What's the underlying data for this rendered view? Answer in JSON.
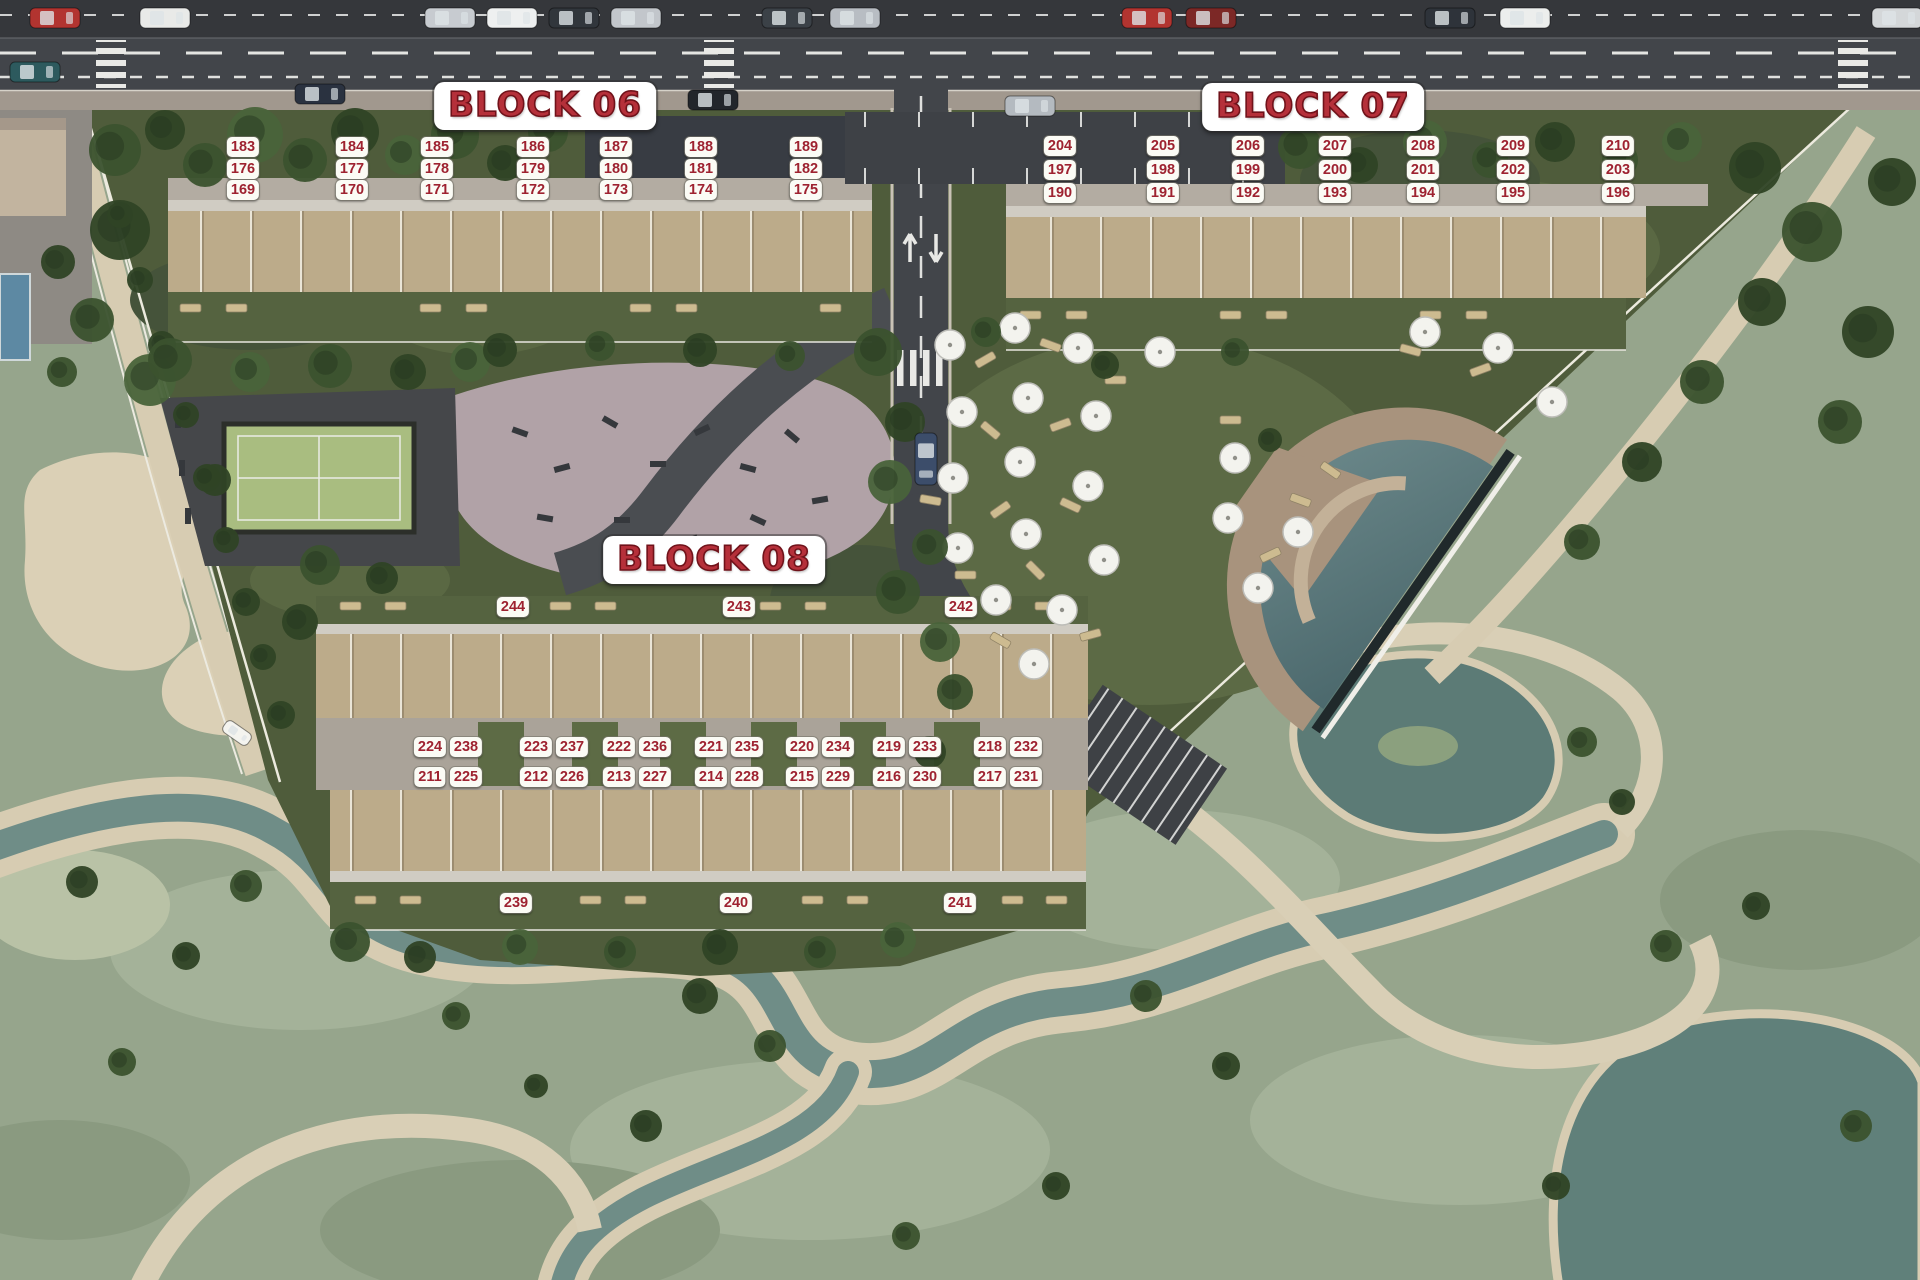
{
  "site": {
    "blocks": [
      {
        "id": "block-06",
        "title": "BLOCK 06",
        "title_x": 545,
        "title_y": 106,
        "units": [
          [
            "183",
            243,
            147
          ],
          [
            "184",
            352,
            147
          ],
          [
            "185",
            437,
            147
          ],
          [
            "186",
            533,
            147
          ],
          [
            "187",
            616,
            147
          ],
          [
            "188",
            701,
            147
          ],
          [
            "189",
            806,
            147
          ],
          [
            "176",
            243,
            169
          ],
          [
            "177",
            352,
            169
          ],
          [
            "178",
            437,
            169
          ],
          [
            "179",
            533,
            169
          ],
          [
            "180",
            616,
            169
          ],
          [
            "181",
            701,
            169
          ],
          [
            "182",
            806,
            169
          ],
          [
            "169",
            243,
            190
          ],
          [
            "170",
            352,
            190
          ],
          [
            "171",
            437,
            190
          ],
          [
            "172",
            533,
            190
          ],
          [
            "173",
            616,
            190
          ],
          [
            "174",
            701,
            190
          ],
          [
            "175",
            806,
            190
          ]
        ]
      },
      {
        "id": "block-07",
        "title": "BLOCK 07",
        "title_x": 1313,
        "title_y": 107,
        "units": [
          [
            "204",
            1060,
            146
          ],
          [
            "205",
            1163,
            146
          ],
          [
            "206",
            1248,
            146
          ],
          [
            "207",
            1335,
            146
          ],
          [
            "208",
            1423,
            146
          ],
          [
            "209",
            1513,
            146
          ],
          [
            "210",
            1618,
            146
          ],
          [
            "197",
            1060,
            170
          ],
          [
            "198",
            1163,
            170
          ],
          [
            "199",
            1248,
            170
          ],
          [
            "200",
            1335,
            170
          ],
          [
            "201",
            1423,
            170
          ],
          [
            "202",
            1513,
            170
          ],
          [
            "203",
            1618,
            170
          ],
          [
            "190",
            1060,
            193
          ],
          [
            "191",
            1163,
            193
          ],
          [
            "192",
            1248,
            193
          ],
          [
            "193",
            1335,
            193
          ],
          [
            "194",
            1423,
            193
          ],
          [
            "195",
            1513,
            193
          ],
          [
            "196",
            1618,
            193
          ]
        ]
      },
      {
        "id": "block-08",
        "title": "BLOCK 08",
        "title_x": 714,
        "title_y": 560,
        "units": [
          [
            "244",
            513,
            607
          ],
          [
            "243",
            739,
            607
          ],
          [
            "242",
            961,
            607
          ],
          [
            "224",
            430,
            747
          ],
          [
            "238",
            466,
            747
          ],
          [
            "223",
            536,
            747
          ],
          [
            "237",
            572,
            747
          ],
          [
            "222",
            619,
            747
          ],
          [
            "236",
            655,
            747
          ],
          [
            "221",
            711,
            747
          ],
          [
            "235",
            747,
            747
          ],
          [
            "220",
            802,
            747
          ],
          [
            "234",
            838,
            747
          ],
          [
            "219",
            889,
            747
          ],
          [
            "233",
            925,
            747
          ],
          [
            "218",
            990,
            747
          ],
          [
            "232",
            1026,
            747
          ],
          [
            "211",
            430,
            777
          ],
          [
            "225",
            466,
            777
          ],
          [
            "212",
            536,
            777
          ],
          [
            "226",
            572,
            777
          ],
          [
            "213",
            619,
            777
          ],
          [
            "227",
            655,
            777
          ],
          [
            "214",
            711,
            777
          ],
          [
            "228",
            747,
            777
          ],
          [
            "215",
            802,
            777
          ],
          [
            "229",
            838,
            777
          ],
          [
            "216",
            889,
            777
          ],
          [
            "230",
            925,
            777
          ],
          [
            "217",
            990,
            777
          ],
          [
            "231",
            1026,
            777
          ],
          [
            "239",
            516,
            903
          ],
          [
            "240",
            736,
            903
          ],
          [
            "241",
            960,
            903
          ]
        ]
      }
    ]
  },
  "colors": {
    "label_text": "#9e2230",
    "label_bg": "#fbfbf5",
    "title_text": "#b5303a",
    "title_outline": "#70121a",
    "title_bg": "#ffffff",
    "road": "#42454a",
    "sidewalk": "#a1988e",
    "site_grass": "#4f5c3b",
    "golf_grass": "#96a58c",
    "sand": "#dbd0b6",
    "wood_terrace": "#bcab8a",
    "pool_water": "#5e7d80",
    "pool_deck": "#a8937d",
    "padel_court": "#a9bd80",
    "plaza": "#b1a2a7"
  }
}
